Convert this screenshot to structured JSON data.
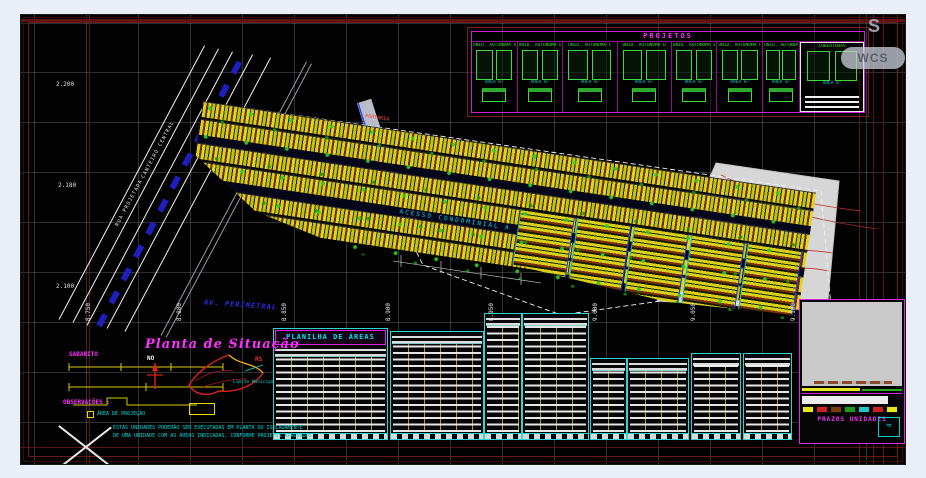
{
  "viewer": {
    "wcs_label": "WCS",
    "compass_letter": "S"
  },
  "axes": {
    "left_labels": [
      "2.200",
      "2.180",
      "2.100"
    ],
    "bottom_labels": [
      "8.750",
      "8.800",
      "8.850",
      "8.900",
      "8.950",
      "9.000",
      "9.050",
      "9.100"
    ]
  },
  "projetos": {
    "title": "PROJETOS",
    "panels": [
      {
        "label": "UNID. AUTÔNOMA A",
        "caption": "ÁREA m²"
      },
      {
        "label": "UNID. AUTÔNOMA B",
        "caption": "ÁREA m²"
      },
      {
        "label": "UNID. AUTÔNOMA C",
        "caption": "ÁREA m²"
      },
      {
        "label": "UNID. AUTÔNOMA D",
        "caption": "ÁREA m²"
      },
      {
        "label": "UNID. AUTÔNOMA E",
        "caption": "ÁREA m²"
      },
      {
        "label": "UNID. AUTÔNOMA F",
        "caption": "ÁREA m²"
      },
      {
        "label": "UNID. AUTÔNOMA G",
        "caption": "ÁREA m²"
      },
      {
        "label": "COBERTURAS",
        "caption": "ÁREA m²"
      }
    ]
  },
  "plan": {
    "main_road_label": "ACESSO CONDOMINIAL A",
    "avenue_label": "AV. PERIMETRAL",
    "street_label_1": "RUA PROJETADA",
    "street_label_2": "CANTEIRO CENTRAL",
    "entry_label": "PORTARIA"
  },
  "site": {
    "title": "Planta de Situação",
    "north_label": "NO",
    "state_label": "RS",
    "map_label_1": "Limite Municipal",
    "gabarito_title": "GABARITO",
    "obs_title": "OBSERVAÇÕES :",
    "obs_item_1": "ÁREA DE PROJEÇÃO"
  },
  "notes": {
    "line_1": "ESTAS UNIDADES PODERÃO SER EXECUTADAS EM PLANTA OU ISOLADAMENTE",
    "line_2": "DE UMA UNIDADE COM AS ÁREAS INDICADAS, CONFORME PROJETOS APROVADOS"
  },
  "tables": {
    "t1_title": "PLANILHA DE ÁREAS"
  },
  "legend": {
    "title": "PRAZOS UNIDADES",
    "swatch_colors": [
      "#e6e620",
      "#cc2020",
      "#7a3a10",
      "#1f9a1f",
      "#20c8c8",
      "#cc2020",
      "#e6e620"
    ]
  },
  "colors": {
    "magenta": "#ff00ff",
    "cyan": "#00e5e5",
    "green": "#3ddc3d",
    "yellow": "#e6d800",
    "maroon_frame": "#5e1414",
    "canvas_bg": "#020202"
  }
}
